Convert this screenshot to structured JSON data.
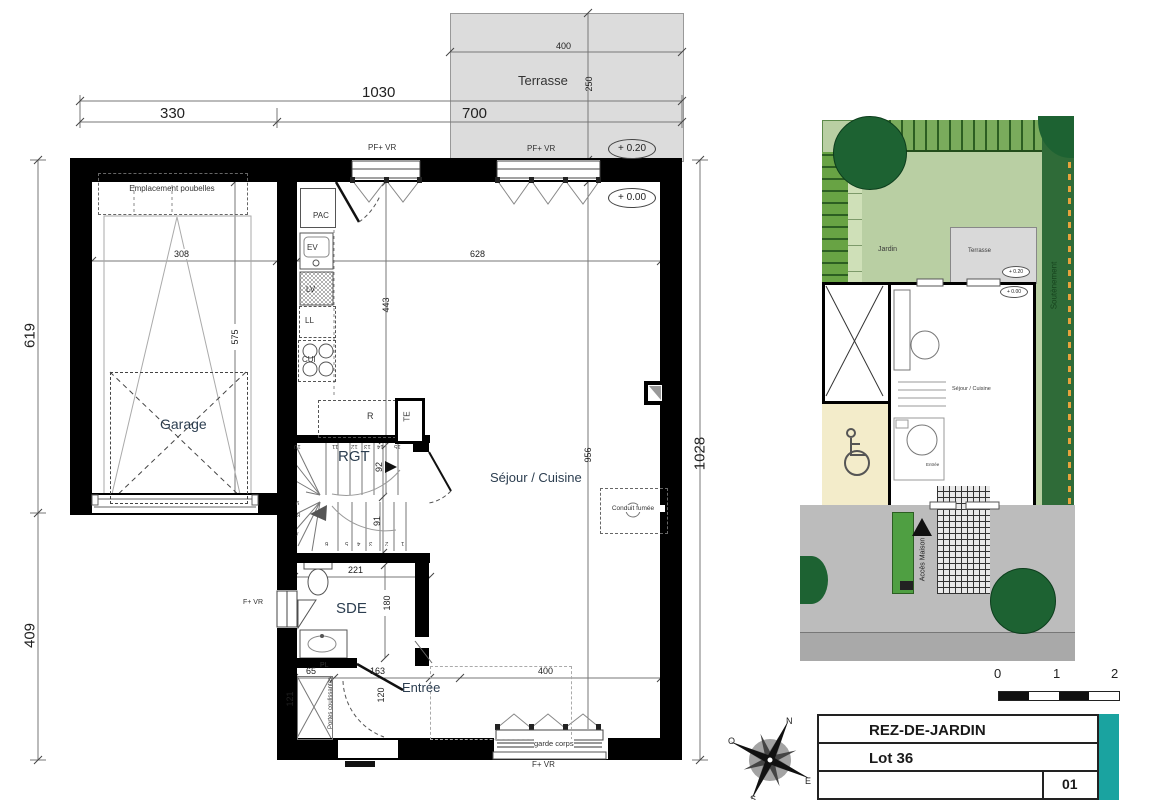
{
  "plan": {
    "terrace_label": "Terrasse",
    "elev_terrace": "+ 0.20",
    "elev_ground": "+ 0.00",
    "dim_1030": "1030",
    "dim_330": "330",
    "dim_700": "700",
    "dim_400_terrace": "400",
    "dim_250": "250",
    "dim_619": "619",
    "dim_409": "409",
    "dim_1028": "1028",
    "dim_308": "308",
    "dim_575": "575",
    "dim_443": "443",
    "dim_628": "628",
    "dim_956": "956",
    "dim_92": "92",
    "dim_91": "91",
    "dim_221": "221",
    "dim_180": "180",
    "dim_65": "65",
    "dim_163": "163",
    "dim_121": "121",
    "dim_120": "120",
    "dim_400_bottom": "400",
    "garage_label": "Garage",
    "bins_label": "Emplacement poubelles",
    "pac": "PAC",
    "ev": "EV",
    "lv": "LV",
    "ll": "LL",
    "cui": "CUI",
    "fridge": "R",
    "te": "TE",
    "rgt": "RGT",
    "sde": "SDE",
    "pl": "PL",
    "entry": "Entrée",
    "living": "Séjour / Cuisine",
    "conduit": "Conduit fumée",
    "sliding_doors": "Portes coulissantes",
    "guardrail": "garde corps",
    "window_pf_vr": "PF+ VR",
    "window_f_vr": "F+ VR",
    "stairs_upper": [
      "10",
      "11",
      "12",
      "13",
      "14",
      "15"
    ],
    "stairs_lower": [
      "1",
      "2",
      "3",
      "4",
      "5",
      "6",
      "7",
      "8",
      "9"
    ]
  },
  "site": {
    "jardin": "Jardin",
    "terrasse": "Terrasse",
    "soutenement": "Soutènement",
    "access": "Accès Maison",
    "living": "Séjour / Cuisine",
    "entry": "Entrée",
    "elev_terrace": "+ 0.20",
    "elev_ground": "+ 0.00"
  },
  "titleblock": {
    "level": "REZ-DE-JARDIN",
    "lot": "Lot 36",
    "sheet": "01"
  },
  "scalebar": {
    "t0": "0",
    "t1": "1",
    "t2": "2"
  },
  "compass": {
    "n": "N",
    "e": "E",
    "s": "S",
    "o": "O"
  },
  "colors": {
    "wall": "#000000",
    "terrace_fill": "#dcdcdc",
    "teal": "#1aa3a0",
    "garden_light": "#b9cfa3",
    "hedge_dark": "#2f6b38",
    "tree": "#1d6232",
    "hedge_left": "#68a344",
    "hedge_top": "#7aab5c",
    "cream": "#f3ecca",
    "drive_gray": "#bcbcbc",
    "street_gray": "#a9a9a9",
    "access_green": "#4f9f42",
    "dash_orange": "#e8a33d"
  }
}
